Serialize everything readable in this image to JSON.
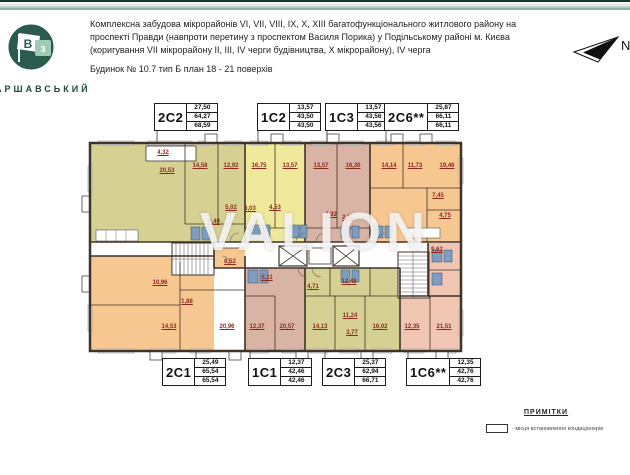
{
  "header": {
    "line1": "Комплексна забудова мікрорайонів VI, VII, VIII, IX, X, XIII багатофункціонального житлового району на",
    "line2": "проспекті Правди (навпроти перетину з проспектом Василя Порика) у Подільському районі м. Києва",
    "line3": "(коригування VII мікрорайону II, III, IV черги будівництва, X мікрорайону),  IV черга",
    "building": "Будинок № 10.7   тип Б   план 18 - 21 поверхів"
  },
  "logo": {
    "flag_letter": "В",
    "square_letter": "з",
    "brand": "ВАРШАВСЬКИЙ",
    "circle_color": "#2b5a4e",
    "square_color": "#9ecbb1"
  },
  "compass": {
    "label": "N"
  },
  "apartments_top": [
    {
      "type": "2C2",
      "values": [
        "27,50",
        "64,27",
        "68,59"
      ]
    },
    {
      "type": "1C2",
      "values": [
        "13,57",
        "43,50",
        "43,50"
      ]
    },
    {
      "type": "1C3",
      "values": [
        "13,57",
        "43,56",
        "43,56"
      ]
    },
    {
      "type": "2C6**",
      "values": [
        "25,87",
        "66,11",
        "66,11"
      ]
    }
  ],
  "apartments_bottom": [
    {
      "type": "2C1",
      "values": [
        "25,49",
        "65,54",
        "65,54"
      ]
    },
    {
      "type": "1C1",
      "values": [
        "12,37",
        "42,46",
        "42,46"
      ]
    },
    {
      "type": "2C3",
      "values": [
        "25,37",
        "62,94",
        "66,71"
      ]
    },
    {
      "type": "1C6**",
      "values": [
        "12,35",
        "42,76",
        "42,76"
      ]
    }
  ],
  "plan": {
    "colors": {
      "olive": "#d6d193",
      "yellow": "#f0e99b",
      "rose": "#d9b3a3",
      "orange": "#f7c791",
      "pink": "#f0c6b3",
      "wall": "#3f332a",
      "label": "#8c2b1d"
    },
    "rooms": [
      {
        "apt": "2C2",
        "area": "4,32",
        "x": 163,
        "y": 153
      },
      {
        "apt": "2C2",
        "area": "20,53",
        "x": 167,
        "y": 171
      },
      {
        "apt": "2C2",
        "area": "14,58",
        "x": 200,
        "y": 166
      },
      {
        "apt": "2C2",
        "area": "12,92",
        "x": 231,
        "y": 166
      },
      {
        "apt": "2C2",
        "area": "9,49",
        "x": 214,
        "y": 222
      },
      {
        "apt": "2C2",
        "area": "5,02",
        "x": 231,
        "y": 208
      },
      {
        "apt": "1C2",
        "area": "16,75",
        "x": 259,
        "y": 166
      },
      {
        "apt": "1C2",
        "area": "13,57",
        "x": 290,
        "y": 166
      },
      {
        "apt": "1C2",
        "area": "3,03",
        "x": 250,
        "y": 209
      },
      {
        "apt": "1C2",
        "area": "4,53",
        "x": 275,
        "y": 208
      },
      {
        "apt": "1C3",
        "area": "13,57",
        "x": 321,
        "y": 166
      },
      {
        "apt": "1C3",
        "area": "16,30",
        "x": 353,
        "y": 166
      },
      {
        "apt": "1C3",
        "area": "4,92",
        "x": 331,
        "y": 215
      },
      {
        "apt": "1C3",
        "area": "2,96",
        "x": 348,
        "y": 218
      },
      {
        "apt": "2C6",
        "area": "14,14",
        "x": 389,
        "y": 166
      },
      {
        "apt": "2C6",
        "area": "11,73",
        "x": 415,
        "y": 166
      },
      {
        "apt": "2C6",
        "area": "19,46",
        "x": 447,
        "y": 166
      },
      {
        "apt": "2C6",
        "area": "7,45",
        "x": 438,
        "y": 196
      },
      {
        "apt": "2C6",
        "area": "4,75",
        "x": 445,
        "y": 216
      },
      {
        "apt": "2C1",
        "area": "8,52",
        "x": 230,
        "y": 262
      },
      {
        "apt": "2C1",
        "area": "10,96",
        "x": 160,
        "y": 283
      },
      {
        "apt": "2C1",
        "area": "1,88",
        "x": 187,
        "y": 302
      },
      {
        "apt": "2C1",
        "area": "14,53",
        "x": 169,
        "y": 327
      },
      {
        "apt": "2C1",
        "area": "20,96",
        "x": 227,
        "y": 327
      },
      {
        "apt": "1C1",
        "area": "5,11",
        "x": 267,
        "y": 278
      },
      {
        "apt": "1C1",
        "area": "12,37",
        "x": 257,
        "y": 327
      },
      {
        "apt": "1C1",
        "area": "20,57",
        "x": 287,
        "y": 327
      },
      {
        "apt": "2C3",
        "area": "4,71",
        "x": 313,
        "y": 287
      },
      {
        "apt": "2C3",
        "area": "12,48",
        "x": 349,
        "y": 282
      },
      {
        "apt": "2C3",
        "area": "11,24",
        "x": 350,
        "y": 316
      },
      {
        "apt": "2C3",
        "area": "3,77",
        "x": 352,
        "y": 333
      },
      {
        "apt": "2C3",
        "area": "14,13",
        "x": 320,
        "y": 327
      },
      {
        "apt": "2C3",
        "area": "16,02",
        "x": 380,
        "y": 327
      },
      {
        "apt": "1C6",
        "area": "9,62",
        "x": 437,
        "y": 250
      },
      {
        "apt": "1C6",
        "area": "12,35",
        "x": 412,
        "y": 327
      },
      {
        "apt": "1C6",
        "area": "21,51",
        "x": 444,
        "y": 327
      }
    ]
  },
  "watermark": "VALION",
  "legend": {
    "title": "ПРИМІТКИ",
    "item": "- місця встановлення кондиціонерів"
  }
}
